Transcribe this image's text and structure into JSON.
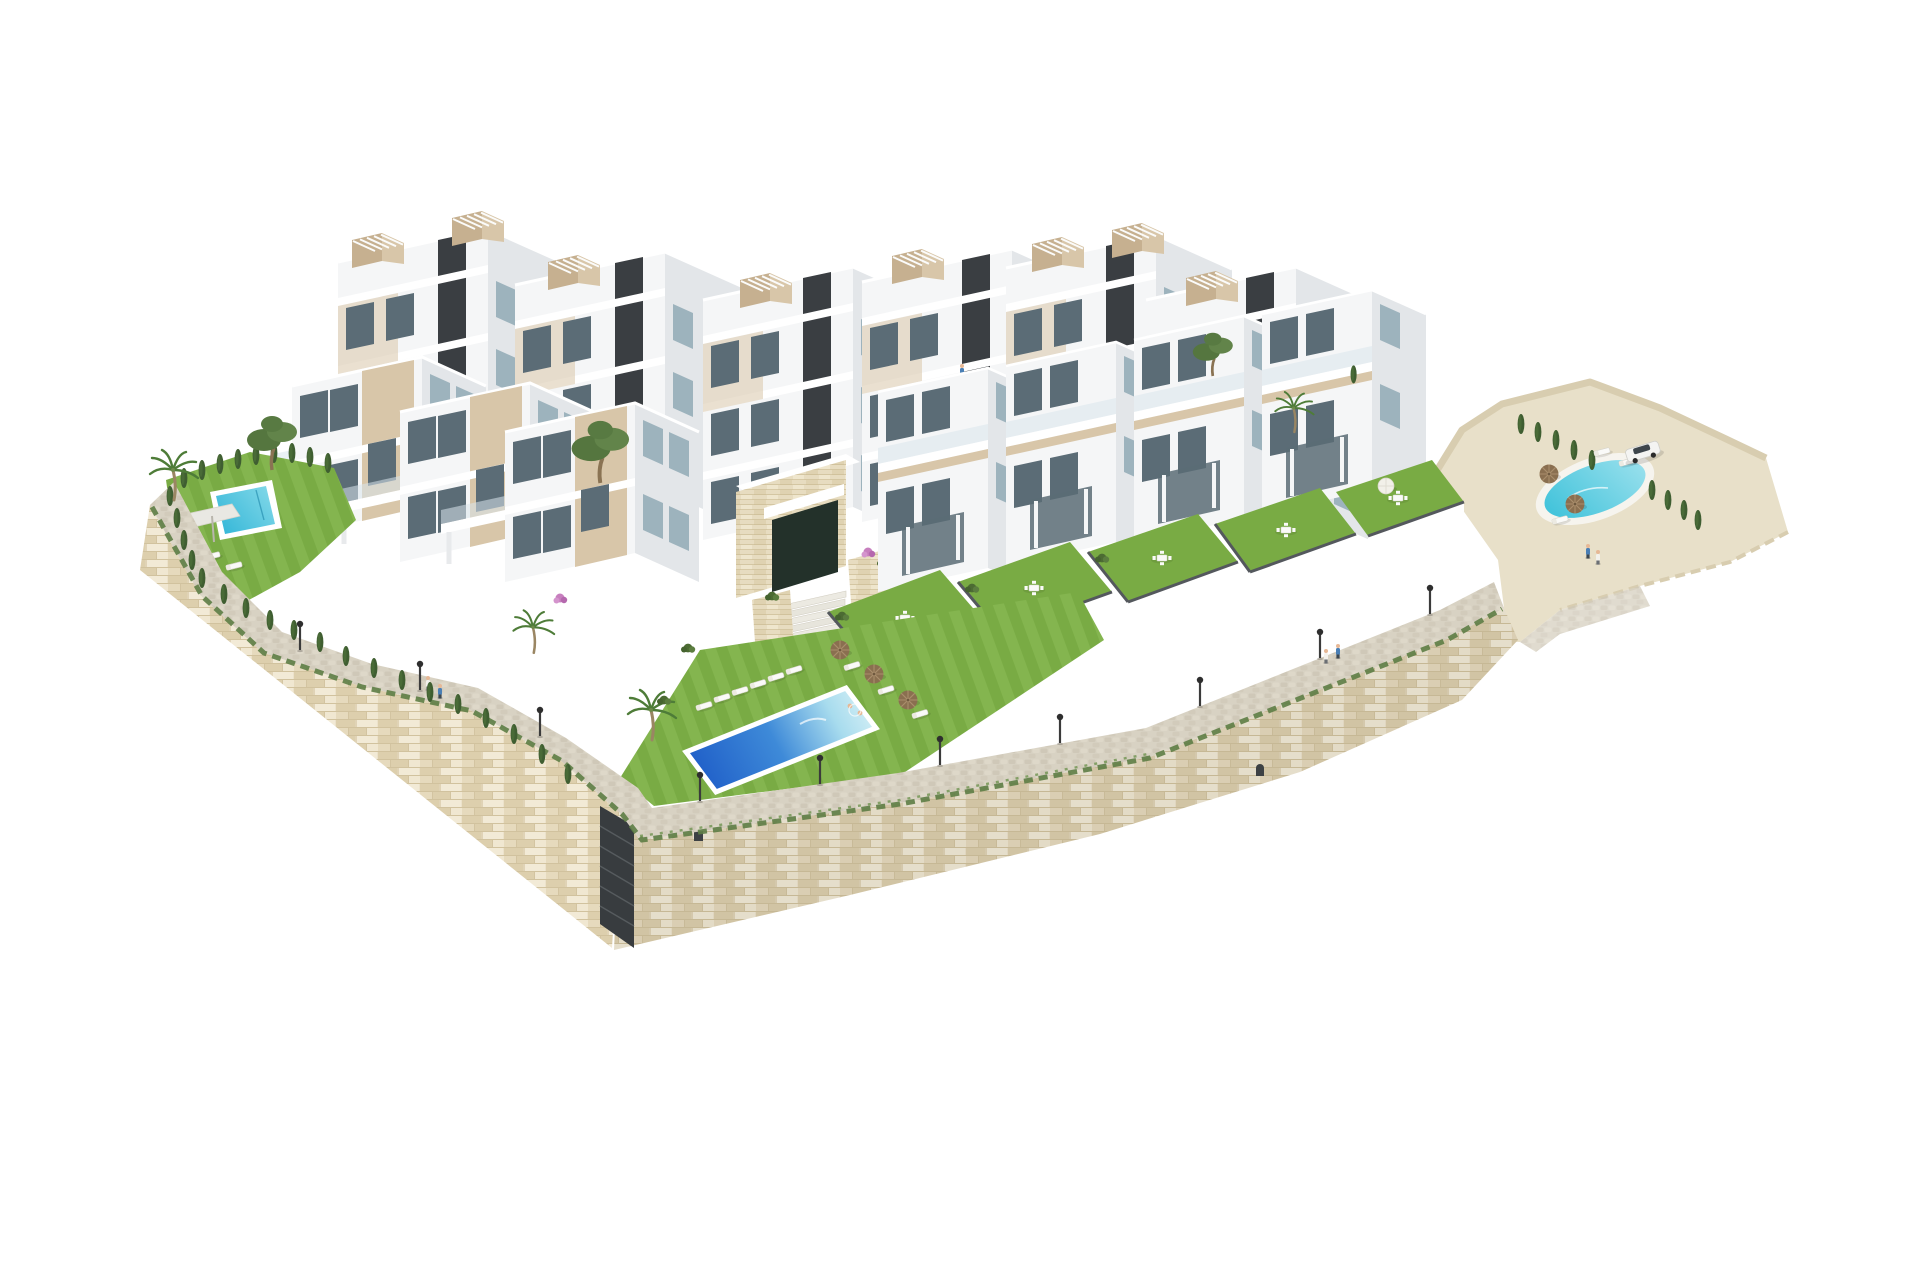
{
  "scene": {
    "type": "3d-architectural-render",
    "subject": "Aerial isometric render of a white hillside residential complex with terraced apartment buildings, private gardens, three swimming pools, a cobbled promenade and cream stone retaining walls on a plain white background",
    "background_color": "#ffffff"
  },
  "palette": {
    "bld-front": "#f5f6f7",
    "bld-side": "#e3e6e9",
    "bld-shade": "#c9ced3",
    "bld-roof": "#eef0f1",
    "beige": "#d8c6a9",
    "beige-sh": "#c6b090",
    "anthracite": "#3a3e42",
    "glass": "#5b6c76",
    "glass-lt": "#9db3bd",
    "railing": "#d9e6ec",
    "lawn": "#79ab44",
    "lawn-lt": "#8cbd57",
    "hedge": "#4c6b33",
    "cypress": "#3f5e31",
    "pine": "#55763f",
    "palm": "#4e7c38",
    "stone-light": "#ece2cb",
    "stone-mid": "#ddcfad",
    "stone-dark": "#c9b890",
    "cobble": "#d8d2c3",
    "sand": "#e8e0c9",
    "sand-sh": "#d8cdb0",
    "pool-deep": "#1f5ec8",
    "pool-mid": "#3e8ad8",
    "pool-light": "#a8dcee",
    "pool-cyan": "#35b7d8",
    "pool-turquoise": "#3fc2da",
    "umbrella": "#8a6f50",
    "furn": "#fafaf8",
    "scrub": "#5d7d45",
    "flower": "#c77fbe",
    "trunk": "#9a8663"
  },
  "elements": {
    "structures": [
      "back-row-apartment-towers",
      "front-row-terraced-villas",
      "townhouse-row-with-private-gardens",
      "stone-clad-entrance-with-stairs",
      "stone-retaining-walls",
      "cobbled-promenade",
      "rooftop-pergolas",
      "external-stairwell-in-wall"
    ],
    "amenities": [
      "central-community-pool",
      "left-garden-pool",
      "right-community-pool",
      "sun-loungers",
      "brown-parasols",
      "white-parasol",
      "shade-sail",
      "garden-furniture-sets",
      "street-lamps"
    ],
    "vegetation": [
      "palm-trees",
      "pine-trees",
      "cypress-hedges",
      "overhanging-crest-grasses",
      "shrubs",
      "pink-bougainvillea"
    ],
    "vehicles": [
      "white-suv-parked-on-sand-terrace"
    ],
    "people": [
      "promenade-pedestrians",
      "swimmers-in-central-pool",
      "terrace-figure"
    ],
    "counts": {
      "swimming_pools": 3,
      "parked_cars": 1
    }
  }
}
